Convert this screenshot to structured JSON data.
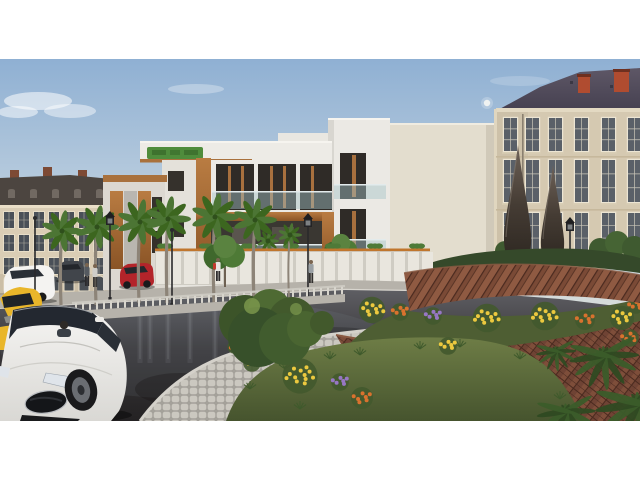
{
  "scene": {
    "kind": "architectural-3d-render",
    "description": "Evening street scene: modern white apartment block with wood accents flanked by classical mansard-roof buildings, palm-lined wet asphalt street with white sedan, yellow taxi and red hatchback, landscaped brick roundabout with flower beds, paver walkway and two dark teardrop sculptures, pale sky with small moon, white letterbox bars top and bottom.",
    "letterbox": "white"
  },
  "palette": {
    "sky_top": "#8fb0d3",
    "sky_mid": "#c3d3e0",
    "sky_low": "#e6e3d8",
    "cloud": "#ffffff",
    "moon": "#f2f4f1",
    "classic_facade": "#dacdb5",
    "classic_base": "#cbbea6",
    "classic_roof": "#4c4540",
    "classic_cornice": "#eadfc8",
    "classic_window": "#4a5058",
    "classic_frame": "#ece3cd",
    "chimney_brick": "#7d4a35",
    "right_facade": "#d5c9b1",
    "right_wing": "#cdc1a9",
    "right_chimney": "#b04c30",
    "right_frame": "#ece5d3",
    "right_glass": "#5a6068",
    "string_course": "#c6b89c",
    "modern_white": "#ebe9e4",
    "modern_white2": "#e4e1da",
    "modern_cream": "#e3ddce",
    "modern_dark": "#2f2b27",
    "wood_hi": "#b97c42",
    "wood_lo": "#8a5426",
    "glass_rail": "rgba(165,195,200,0.45)",
    "rail_line": "#e3ebec",
    "sign_green": "#4f8c3c",
    "sign_green_dark": "#3b6d2c",
    "fence_panel": "#e9e6de",
    "fence_gap": "#cfccc3",
    "fence_orange": "#c0762e",
    "sidewalk": "#b6b2aa",
    "curb": "#d6d3cb",
    "median": "#b7b3ab",
    "baluster": "#d8d5cd",
    "asphalt_hi": "#5e5e63",
    "asphalt_lo": "#242223",
    "reflect": "#dfe6ee",
    "paver_bg": "#a4a19a",
    "paver_stone": "#cbc8c0",
    "grass_hi": "#6e7d46",
    "grass_lo": "#4a5730",
    "hedge": "#35492a",
    "foliage": "#4e7a36",
    "foliage_dark": "#3c661f",
    "palm_trunk": "#8d8478",
    "frond_dark": "#2f4a22",
    "brick_base": "#6f4334",
    "brick_hi": "#8f5a42",
    "brick_dark": "#4a2a1f",
    "flower_yellow": "#ecc93f",
    "flower_orange": "#d9722e",
    "flower_purple": "#9777c4",
    "sculpt_hi": "#6e6258",
    "sculpt_lo": "#2c2620",
    "car_white": "#f4f3f1",
    "car_glass": "#232830",
    "car_yellow": "#e9b62a",
    "car_red": "#b3242a",
    "car_dark": "#41454b",
    "wheel": "#1a1a1c",
    "rim": "#6a6d72",
    "lamp": "#2a2a2c"
  },
  "moon": {
    "cx": 487,
    "cy": 44,
    "r": 3.2
  },
  "clouds": [
    {
      "cx": 38,
      "cy": 42,
      "rx": 34,
      "ry": 9,
      "o": 0.55
    },
    {
      "cx": 70,
      "cy": 52,
      "rx": 26,
      "ry": 7,
      "o": 0.45
    },
    {
      "cx": 18,
      "cy": 53,
      "rx": 20,
      "ry": 6,
      "o": 0.5
    },
    {
      "cx": 196,
      "cy": 30,
      "rx": 28,
      "ry": 5,
      "o": 0.3
    },
    {
      "cx": 520,
      "cy": 22,
      "rx": 30,
      "ry": 5,
      "o": 0.18
    }
  ],
  "left_building": {
    "windows": {
      "x0": 4,
      "cols": 11,
      "w": 10,
      "pitch": 15,
      "rows": [
        {
          "y": 153,
          "h": 16
        },
        {
          "y": 176,
          "h": 16
        },
        {
          "y": 199,
          "h": 16
        }
      ]
    },
    "arches": {
      "y": 217,
      "h": 15
    },
    "dormers": {
      "x0": 8,
      "n": 7,
      "pitch": 22,
      "y": 130,
      "w": 7,
      "h": 9
    },
    "chimneys": [
      10,
      43,
      78
    ]
  },
  "right_building": {
    "window_cols": [
      504,
      526,
      549,
      575,
      602,
      628
    ],
    "w": 13,
    "rows": [
      {
        "y": 59,
        "h": 33
      },
      {
        "y": 101,
        "h": 42
      },
      {
        "y": 154,
        "h": 38
      }
    ],
    "chimneys": [
      {
        "x": 578,
        "y": 16,
        "w": 12,
        "h": 18
      },
      {
        "x": 614,
        "y": 11,
        "w": 15,
        "h": 22
      }
    ]
  },
  "vegetation": {
    "palms": [
      {
        "x": 62,
        "cy": 172,
        "r": 21,
        "base": 246,
        "layer": "street"
      },
      {
        "x": 97,
        "cy": 168,
        "r": 22,
        "base": 246,
        "layer": "street"
      },
      {
        "x": 140,
        "cy": 163,
        "r": 23,
        "base": 244,
        "layer": "street"
      },
      {
        "x": 168,
        "cy": 160,
        "r": 23,
        "base": 244,
        "layer": "street"
      },
      {
        "x": 215,
        "cy": 158,
        "r": 24,
        "base": 244,
        "layer": "street"
      },
      {
        "x": 255,
        "cy": 161,
        "r": 22,
        "base": 244,
        "layer": "street"
      },
      {
        "x": 290,
        "cy": 176,
        "r": 12,
        "base": 240,
        "layer": "street"
      },
      {
        "x": 268,
        "cy": 182,
        "r": 11,
        "base": 216,
        "layer": "far"
      }
    ],
    "trees": [
      {
        "x": 225,
        "cy": 196,
        "r": 21,
        "base": 228,
        "layer": "street"
      },
      {
        "x": 341,
        "cy": 191,
        "r": 17,
        "base": 218,
        "layer": "far"
      }
    ],
    "tufts": [
      [
        250,
        330
      ],
      [
        285,
        310
      ],
      [
        330,
        300
      ],
      [
        360,
        296
      ],
      [
        300,
        350
      ],
      [
        340,
        330
      ],
      [
        420,
        290
      ],
      [
        460,
        288
      ],
      [
        520,
        300
      ],
      [
        250,
        302
      ],
      [
        560,
        340
      ]
    ],
    "frond_fans": [
      {
        "x": 604,
        "y": 296,
        "r": 26
      },
      {
        "x": 638,
        "y": 344,
        "r": 32
      },
      {
        "x": 566,
        "y": 352,
        "r": 22
      },
      {
        "x": 556,
        "y": 292,
        "r": 15
      }
    ]
  },
  "lamps": [
    {
      "x": 35,
      "top": 154,
      "base": 238,
      "style": "pole",
      "layer": "street"
    },
    {
      "x": 110,
      "top": 152,
      "base": 242,
      "style": "lantern",
      "layer": "street"
    },
    {
      "x": 172,
      "top": 166,
      "base": 248,
      "style": "pole",
      "layer": "street"
    },
    {
      "x": 308,
      "top": 154,
      "base": 244,
      "style": "lantern",
      "layer": "street"
    },
    {
      "x": 570,
      "top": 158,
      "base": 195,
      "style": "lantern",
      "layer": "mid"
    }
  ],
  "fence": {
    "x0": 155,
    "x1": 430,
    "y": 191,
    "h": 35,
    "pitch": 14,
    "planter_pitch": 42
  },
  "balustrade": {
    "x0": 72,
    "x1": 345,
    "y0": 252,
    "y1": 235,
    "post_pitch": 7
  },
  "streak_xs": [
    62,
    97,
    140,
    150,
    168,
    190,
    215,
    255
  ],
  "pedestrians": [
    {
      "x": 218,
      "y": 199,
      "shirt": "#e8e6e2",
      "pack": "#c23a2e",
      "pants": "#2e2c2e"
    },
    {
      "x": 311,
      "y": 201,
      "shirt": "#9aa0a4",
      "pants": "#33312f"
    },
    {
      "x": 87,
      "y": 204,
      "shirt": "#555a60",
      "pants": "#2b2a2c"
    },
    {
      "x": 95,
      "y": 205,
      "shirt": "#cfcdc8",
      "pants": "#3a3836"
    }
  ],
  "flower_colors": {
    "yellow": "#ecc93f",
    "orange": "#d9722e",
    "purple": "#9777c4"
  },
  "flower_clusters": [
    {
      "x": 372,
      "y": 250,
      "c": "yellow",
      "r": 12,
      "n": 9,
      "layer": "strip"
    },
    {
      "x": 400,
      "y": 252,
      "c": "orange",
      "r": 8,
      "n": 6,
      "layer": "strip"
    },
    {
      "x": 433,
      "y": 256,
      "c": "purple",
      "r": 8,
      "n": 6,
      "layer": "strip"
    },
    {
      "x": 487,
      "y": 258,
      "c": "yellow",
      "r": 13,
      "n": 10,
      "layer": "strip"
    },
    {
      "x": 545,
      "y": 256,
      "c": "yellow",
      "r": 13,
      "n": 10,
      "layer": "strip"
    },
    {
      "x": 585,
      "y": 260,
      "c": "orange",
      "r": 9,
      "n": 6,
      "layer": "strip"
    },
    {
      "x": 622,
      "y": 258,
      "c": "yellow",
      "r": 11,
      "n": 8,
      "layer": "strip"
    },
    {
      "x": 636,
      "y": 246,
      "c": "orange",
      "r": 7,
      "n": 5,
      "layer": "strip"
    },
    {
      "x": 300,
      "y": 316,
      "c": "yellow",
      "r": 16,
      "n": 12,
      "layer": "bed"
    },
    {
      "x": 340,
      "y": 322,
      "c": "purple",
      "r": 8,
      "n": 6,
      "layer": "bed"
    },
    {
      "x": 362,
      "y": 338,
      "c": "orange",
      "r": 10,
      "n": 7,
      "layer": "bed"
    },
    {
      "x": 252,
      "y": 303,
      "c": "yellow",
      "r": 8,
      "n": 6,
      "layer": "bed"
    },
    {
      "x": 234,
      "y": 287,
      "c": "orange",
      "r": 6,
      "n": 4,
      "layer": "bed"
    },
    {
      "x": 448,
      "y": 286,
      "c": "yellow",
      "r": 8,
      "n": 6,
      "layer": "bed"
    },
    {
      "x": 630,
      "y": 278,
      "c": "orange",
      "r": 8,
      "n": 5,
      "layer": "bed"
    }
  ]
}
